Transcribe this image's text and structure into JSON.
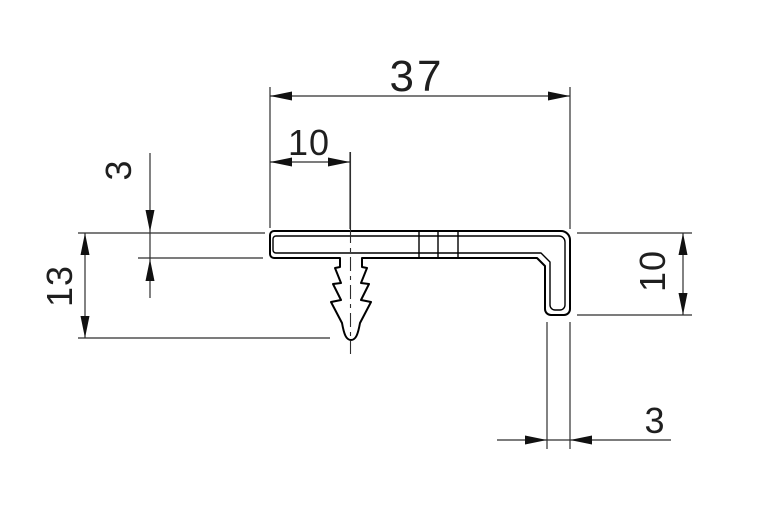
{
  "drawing": {
    "kind": "technical-profile-cross-section",
    "background": "#ffffff",
    "line_color": "#000000",
    "dimension_color": "#2e2e2e",
    "dimensions": {
      "overall_width": {
        "label": "37",
        "orientation": "horizontal"
      },
      "barb_offset": {
        "label": "10",
        "orientation": "horizontal"
      },
      "leaf_thickness": {
        "label": "3",
        "orientation": "vertical"
      },
      "overall_height": {
        "label": "13",
        "orientation": "vertical"
      },
      "flange_height": {
        "label": "10",
        "orientation": "vertical"
      },
      "flange_thickness": {
        "label": "3",
        "orientation": "horizontal"
      }
    }
  }
}
